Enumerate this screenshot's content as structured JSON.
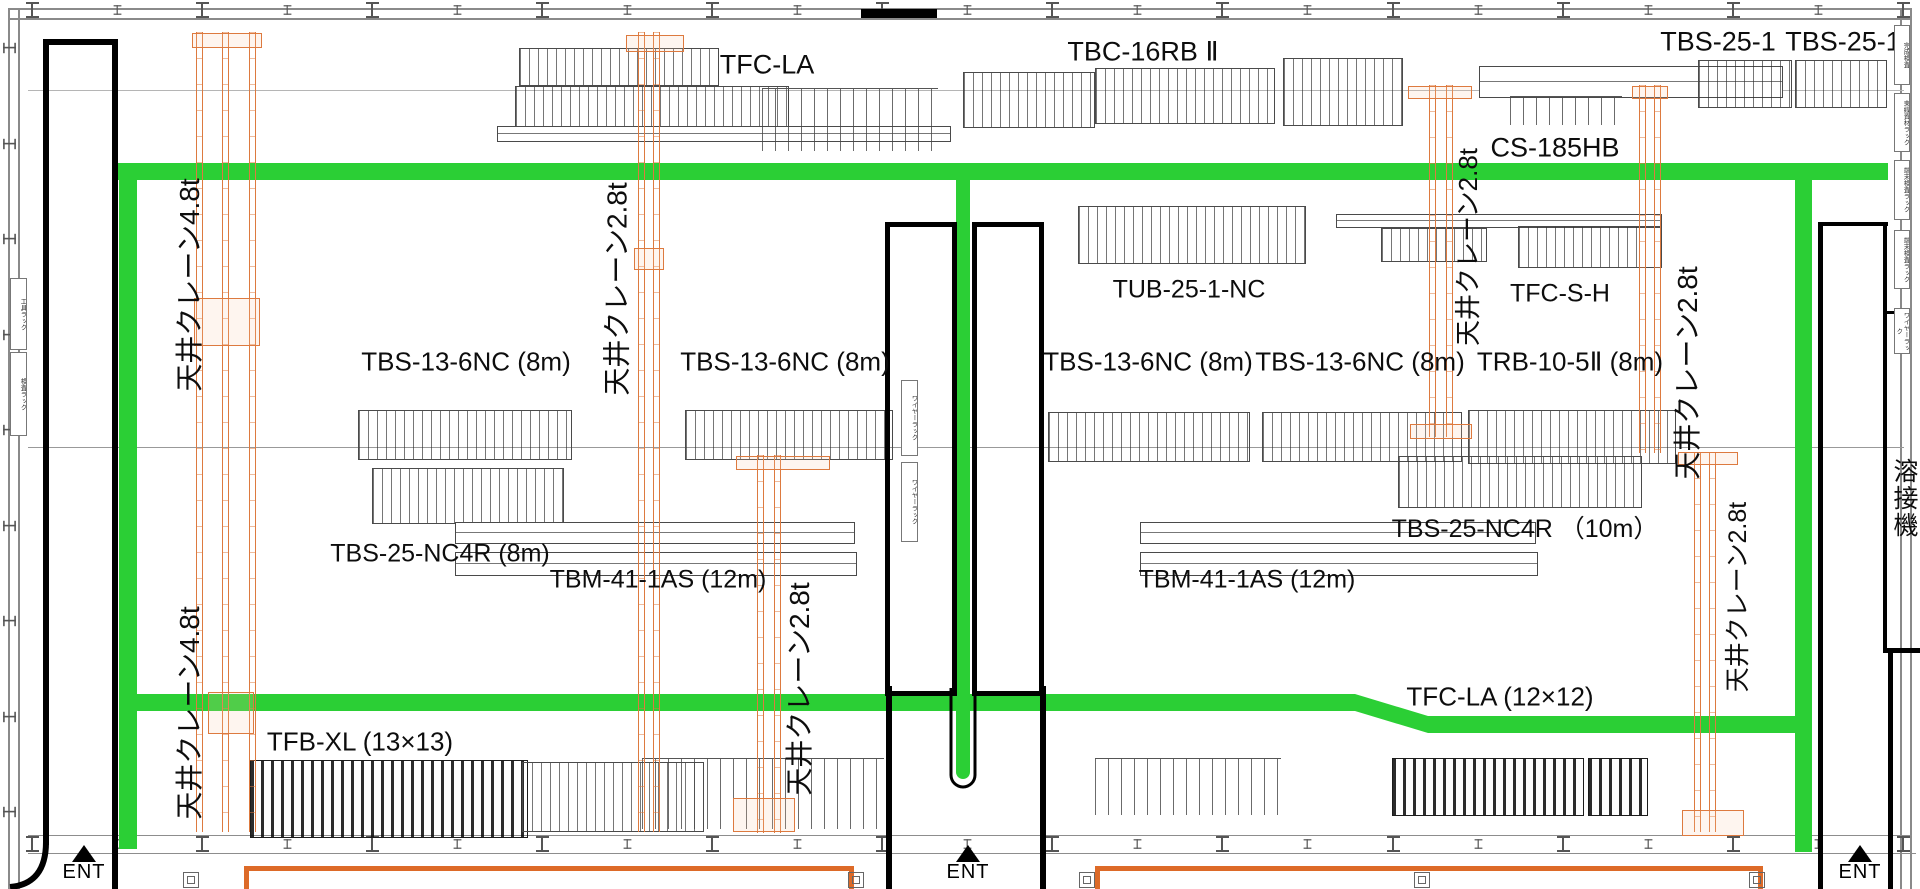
{
  "colors": {
    "walkway_green": "#2bcf35",
    "crane_rail_orange": "#dd7a3f",
    "floor_box_orange": "#dd6a28",
    "wall_black": "#000000",
    "background": "#ffffff"
  },
  "machines": [
    {
      "id": "tfc-la-top",
      "text": "TFC-LA"
    },
    {
      "id": "tbc-16rb2",
      "text": "TBC-16RB Ⅱ"
    },
    {
      "id": "tbs-25-1-a",
      "text": "TBS-25-1"
    },
    {
      "id": "tbs-25-1-b",
      "text": "TBS-25-1"
    },
    {
      "id": "cs-185hb",
      "text": "CS-185HB"
    },
    {
      "id": "tub-25-1-nc",
      "text": "TUB-25-1-NC"
    },
    {
      "id": "tfc-s-h",
      "text": "TFC-S-H"
    },
    {
      "id": "tbs-13-6nc-1",
      "text": "TBS-13-6NC (8m)"
    },
    {
      "id": "tbs-13-6nc-2",
      "text": "TBS-13-6NC (8m)"
    },
    {
      "id": "tbs-13-6nc-3",
      "text": "TBS-13-6NC (8m)"
    },
    {
      "id": "tbs-13-6nc-4",
      "text": "TBS-13-6NC (8m)"
    },
    {
      "id": "trb-10-5-2",
      "text": "TRB-10-5Ⅱ (8m)"
    },
    {
      "id": "tbs-25-nc4r-8m",
      "text": "TBS-25-NC4R (8m)"
    },
    {
      "id": "tbm-41-1as-left",
      "text": "TBM-41-1AS (12m)"
    },
    {
      "id": "tbm-41-1as-right",
      "text": "TBM-41-1AS (12m)"
    },
    {
      "id": "tbs-25-nc4r-10m",
      "text": "TBS-25-NC4R （10m）"
    },
    {
      "id": "tfb-xl",
      "text": "TFB-XL (13×13)"
    },
    {
      "id": "tfc-la-bottom",
      "text": "TFC-LA (12×12)"
    }
  ],
  "cranes": [
    {
      "id": "crane-upper-left",
      "text": "天井クレーン4.8t",
      "capacity": "4.8t"
    },
    {
      "id": "crane-upper-center",
      "text": "天井クレーン2.8t",
      "capacity": "2.8t"
    },
    {
      "id": "crane-upper-right-1",
      "text": "天井クレーン2.8t",
      "capacity": "2.8t"
    },
    {
      "id": "crane-upper-right-2",
      "text": "天井クレーン2.8t",
      "capacity": "2.8t"
    },
    {
      "id": "crane-lower-left",
      "text": "天井クレーン4.8t",
      "capacity": "4.8t"
    },
    {
      "id": "crane-lower-center",
      "text": "天井クレーン2.8t",
      "capacity": "2.8t"
    },
    {
      "id": "crane-lower-right",
      "text": "天井クレーン2.8t",
      "capacity": "2.8t"
    }
  ],
  "areas": {
    "welding": "溶接機"
  },
  "entrances": [
    {
      "id": "ent-left",
      "text": "ENT"
    },
    {
      "id": "ent-center",
      "text": "ENT"
    },
    {
      "id": "ent-right",
      "text": "ENT"
    }
  ],
  "racks": {
    "left": [
      {
        "text": "工具ラック"
      },
      {
        "text": "検査ラック"
      }
    ],
    "right": [
      {
        "text": "完成検査"
      },
      {
        "text": "束線資材ラック"
      },
      {
        "text": "端末検査ラック"
      },
      {
        "text": "端末検査ラック"
      },
      {
        "text": "ワイヤーラック"
      }
    ],
    "inner": [
      {
        "text": "ワイヤーラック"
      },
      {
        "text": "ワイヤーラック"
      }
    ]
  }
}
